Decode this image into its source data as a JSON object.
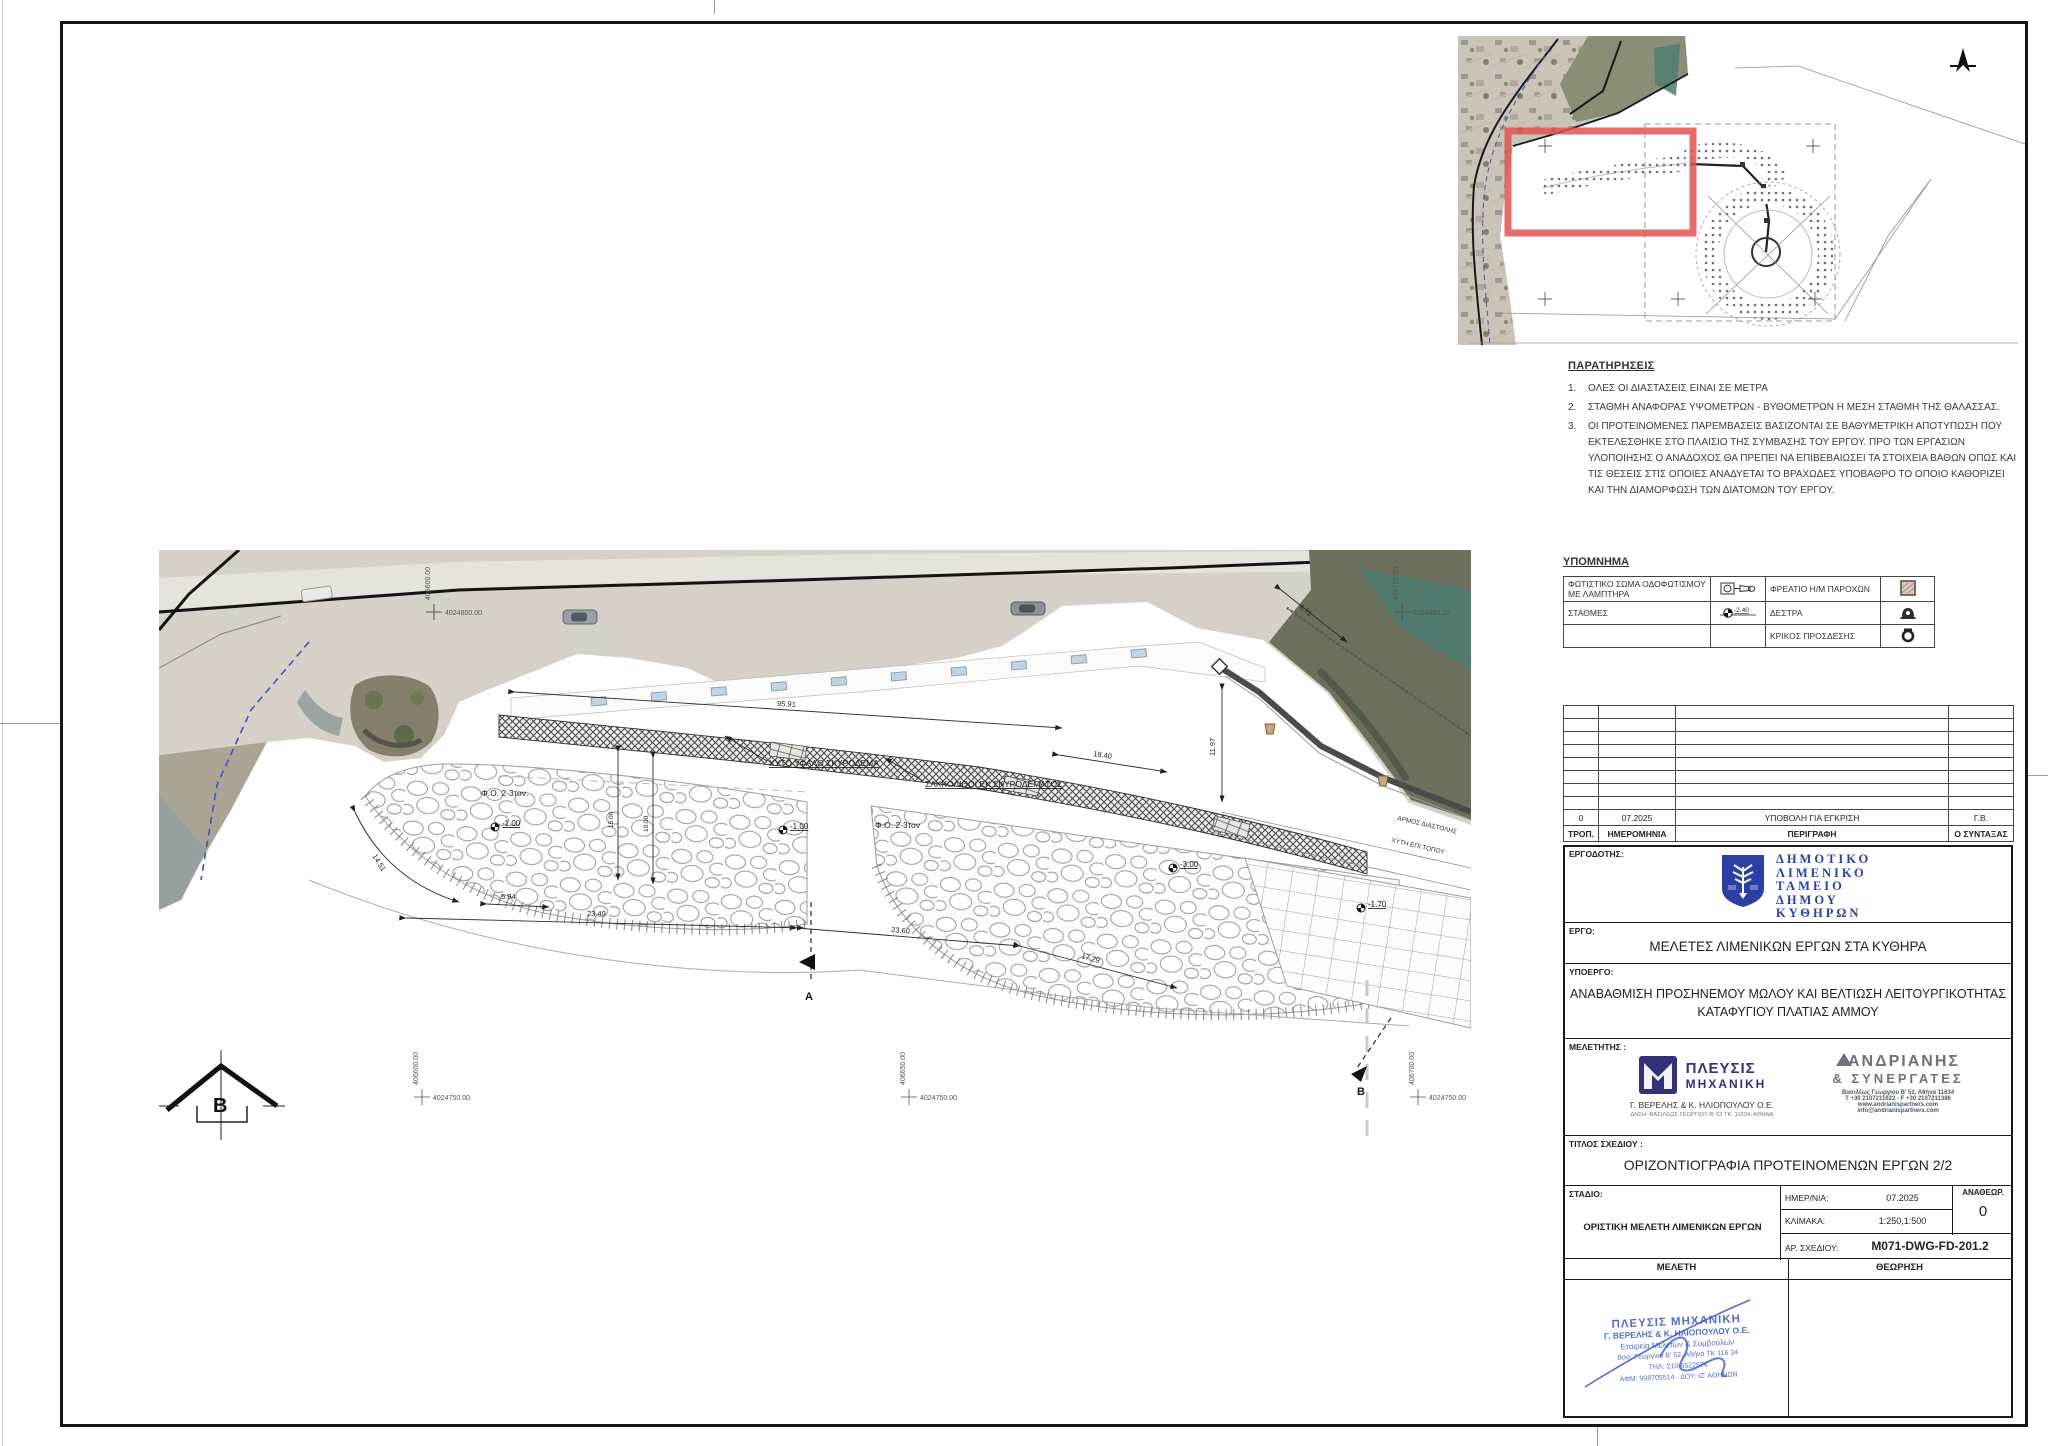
{
  "notes": {
    "title": "ΠΑΡΑΤΗΡΗΣΕΙΣ",
    "item1_no": "1.",
    "item1": "ΟΛΕΣ ΟΙ ΔΙΑΣΤΑΣΕΙΣ ΕΙΝΑΙ ΣΕ ΜΕΤΡΑ",
    "item2_no": "2.",
    "item2": "ΣΤΑΘΜΗ ΑΝΑΦΟΡΑΣ ΥΨΟΜΕΤΡΩΝ - ΒΥΘΟΜΕΤΡΩΝ Η ΜΕΣΗ ΣΤΑΘΜΗ ΤΗΣ ΘΑΛΑΣΣΑΣ.",
    "item3_no": "3.",
    "item3": "ΟΙ ΠΡΟΤΕΙΝΟΜΕΝΕΣ ΠΑΡΕΜΒΑΣΕΙΣ ΒΑΣΙΖΟΝΤΑΙ ΣΕ ΒΑΘΥΜΕΤΡΙΚΗ ΑΠΟΤΥΠΩΣΗ ΠΟΥ ΕΚΤΕΛΕΣΘΗΚΕ ΣΤΟ ΠΛΑΙΣΙΟ ΤΗΣ ΣΥΜΒΑΣΗΣ ΤΟΥ ΕΡΓΟΥ. ΠΡΟ ΤΩΝ ΕΡΓΑΣΙΩΝ ΥΛΟΠΟΙΗΣΗΣ Ο ΑΝΑΔΟΧΟΣ ΘΑ ΠΡΕΠΕΙ ΝΑ ΕΠΙΒΕΒΑΙΩΣΕΙ ΤΑ ΣΤΟΙΧΕΙΑ ΒΑΘΩΝ ΟΠΩΣ ΚΑΙ ΤΙΣ ΘΕΣΕΙΣ ΣΤΙΣ ΟΠΟΙΕΣ ΑΝΑΔΥΕΤΑΙ ΤΟ ΒΡΑΧΩΔΕΣ ΥΠΟΒΑΘΡΟ ΤΟ ΟΠΟΙΟ ΚΑΘΟΡΙΖΕΙ ΚΑΙ ΤΗΝ ΔΙΑΜΟΡΦΩΣΗ ΤΩΝ ΔΙΑΤΟΜΩΝ ΤΟΥ ΕΡΓΟΥ."
  },
  "legend": {
    "title": "ΥΠΟΜΝΗΜΑ",
    "r1c1": "ΦΩΤΙΣΤΙΚΟ ΣΩΜΑ ΟΔΟΦΩΤΙΣΜΟΥ ΜΕ ΛΑΜΠΤΗΡΑ",
    "r1c2": "ΦΡΕΑΤΙΟ Η/Μ ΠΑΡΟΧΩΝ",
    "r2c1": "ΣΤΑΘΜΕΣ",
    "r2c2": "ΔΕΣΤΡΑ",
    "r3c2": "ΚΡΙΚΟΣ ΠΡΟΣΔΕΣΗΣ",
    "level_value": "-2.40"
  },
  "revisions": {
    "rev": "0",
    "date": "07.2025",
    "desc": "ΥΠΟΒΟΛΗ ΓΙΑ ΕΓΚΡΙΣΗ",
    "by": "Γ.Β.",
    "h_rev": "ΤΡΟΠ.",
    "h_date": "ΗΜΕΡΟΜΗΝΙΑ",
    "h_desc": "ΠΕΡΙΓΡΑΦΗ",
    "h_by": "Ο ΣΥΝΤΑΞΑΣ"
  },
  "titleblock": {
    "employer_label": "ΕΡΓΟΔΟΤΗΣ:",
    "employer_l1": "ΔΗΜΟΤΙΚΟ",
    "employer_l2": "ΛΙΜΕΝΙΚΟ",
    "employer_l3": "ΤΑΜΕΙΟ",
    "employer_l4": "ΔΗΜΟΥ",
    "employer_l5": "ΚΥΘΗΡΩΝ",
    "project_label": "ΕΡΓΟ:",
    "project": "ΜΕΛΕΤΕΣ ΛΙΜΕΝΙΚΩΝ ΕΡΓΩΝ ΣΤΑ ΚΥΘΗΡΑ",
    "subproject_label": "ΥΠΟΕΡΓΟ:",
    "subproject_l1": "ΑΝΑΒΑΘΜΙΣΗ ΠΡΟΣΗΝΕΜΟΥ ΜΩΛΟΥ ΚΑΙ ΒΕΛΤΙΩΣΗ ΛΕΙΤΟΥΡΓΙΚΟΤΗΤΑΣ",
    "subproject_l2": "ΚΑΤΑΦΥΓΙΟΥ ΠΛΑΤΙΑΣ ΑΜΜΟΥ",
    "designer_label": "ΜΕΛΕΤΗΤΗΣ :",
    "plefsis_name": "ΠΛΕΥΣΙΣ",
    "plefsis_name2": "ΜΗΧΑΝΙΚΗ",
    "plefsis_company": "Γ. ΒΕΡΕΛΗΣ & Κ. ΗΛΙΟΠΟΥΛΟΥ Ο.Ε.",
    "plefsis_address": "ΔΝΣΗ: ΒΑΣΙΛΕΩΣ ΓΕΩΡΓΙΟΥ Β' 52 ΤΚ: 11634, ΑΘΗΝΑ",
    "andrianis_name": "ΑΝΔΡΙΑΝΗΣ",
    "andrianis_name2": "& ΣΥΝΕΡΓΑΤΕΣ",
    "andrianis_addr1": "Βασιλέως Γεωργίου Β' 52, Αθήνα 11634",
    "andrianis_addr2": "T +30 2107211622 - F +30 2107211386",
    "andrianis_web": "www.andrianispartners.com",
    "andrianis_email": "info@andrianispartners.com",
    "title_label": "ΤΙΤΛΟΣ ΣΧΕΔΙΟΥ :",
    "title": "ΟΡΙΖΟΝΤΙΟΓΡΑΦΙΑ ΠΡΟΤΕΙΝΟΜΕΝΩΝ ΕΡΓΩΝ 2/2",
    "stage_label": "ΣΤΑΔΙΟ:",
    "stage": "ΟΡΙΣΤΙΚΗ ΜΕΛΕΤΗ ΛΙΜΕΝΙΚΩΝ ΕΡΓΩΝ",
    "date_label": "ΗΜΕΡ/ΝΙΑ:",
    "date": "07.2025",
    "scale_label": "ΚΛΙΜΑΚΑ:",
    "scale": "1:250,1:500",
    "number_label": "ΑΡ. ΣΧΕΔΙΟΥ:",
    "number": "M071-DWG-FD-201.2",
    "rev_label": "ΑΝΑΘΕΩΡ.",
    "rev": "0",
    "meleti": "ΜΕΛΕΤΗ",
    "theorisi": "ΘΕΩΡΗΣΗ",
    "stamp_l1": "ΠΛΕΥΣΙΣ ΜΗΧΑΝΙΚΗ",
    "stamp_l2": "Γ. ΒΕΡΕΛΗΣ & Κ. ΗΛΙΟΠΟΥΛΟΥ Ο.Ε.",
    "stamp_l3": "Εταιρεία Μελετών & Συμβούλων",
    "stamp_l4": "Βασ. Γεωργίου Β' 52, Αθήνα ΤΚ 116 34",
    "stamp_l5": "ΤΗΛ: 210-6522576",
    "stamp_l6": "ΑΦΜ: 998705514 - ΔΟΥ: ΙΖ' ΑΘΗΝΩΝ"
  },
  "drawing": {
    "dim_9591": "95.91",
    "dim_2349": "23.49",
    "dim_2360": "23.60",
    "dim_1729": "17.29",
    "dim_1451": "14.51",
    "dim_594": "5.94",
    "dim_1840": "18.40",
    "dim_1197": "11.97",
    "dim_1500": "15.00",
    "dim_1000": "10.00",
    "dim_671": "6.71",
    "lvl_a": "-1.00",
    "lvl_b": "-1.00",
    "lvl_c": "-3.00",
    "lvl_d": "-1.70",
    "lbl_cast": "ΧΥΤΟ ΥΦΑΛΟ ΣΚΥΡΟΔΕΜΑ",
    "lbl_bags": "ΣΑΚΚΟΛΙΘΟΙ ΕΚ ΣΚΥΡΟΔΕΜΑΤΟΣ",
    "lbl_rock1": "Φ.Ο. 2-3τον.",
    "lbl_rock2": "Φ.Ο. 2-3τον",
    "lbl_joint": "ΑΡΜΟΣ ΔΙΑΣΤΟΛΗΣ",
    "lbl_castinsitu": "ΧΥΤΗ ΕΠΙ ΤΟΠΟΥ",
    "sec_a": "A",
    "sec_b": "B",
    "sec_b2": "B",
    "coord_n1": "4024750.00",
    "coord_n2": "4024750.00",
    "coord_n3": "4024750.00",
    "coord_n_top1": "4024800.00",
    "coord_n_top2": "4024800.00",
    "coord_e1": "406600.00",
    "coord_e2": "406650.00",
    "coord_e3": "406700.00",
    "coord_e_top1": "406600.00",
    "coord_e_top2": "406700.00"
  }
}
